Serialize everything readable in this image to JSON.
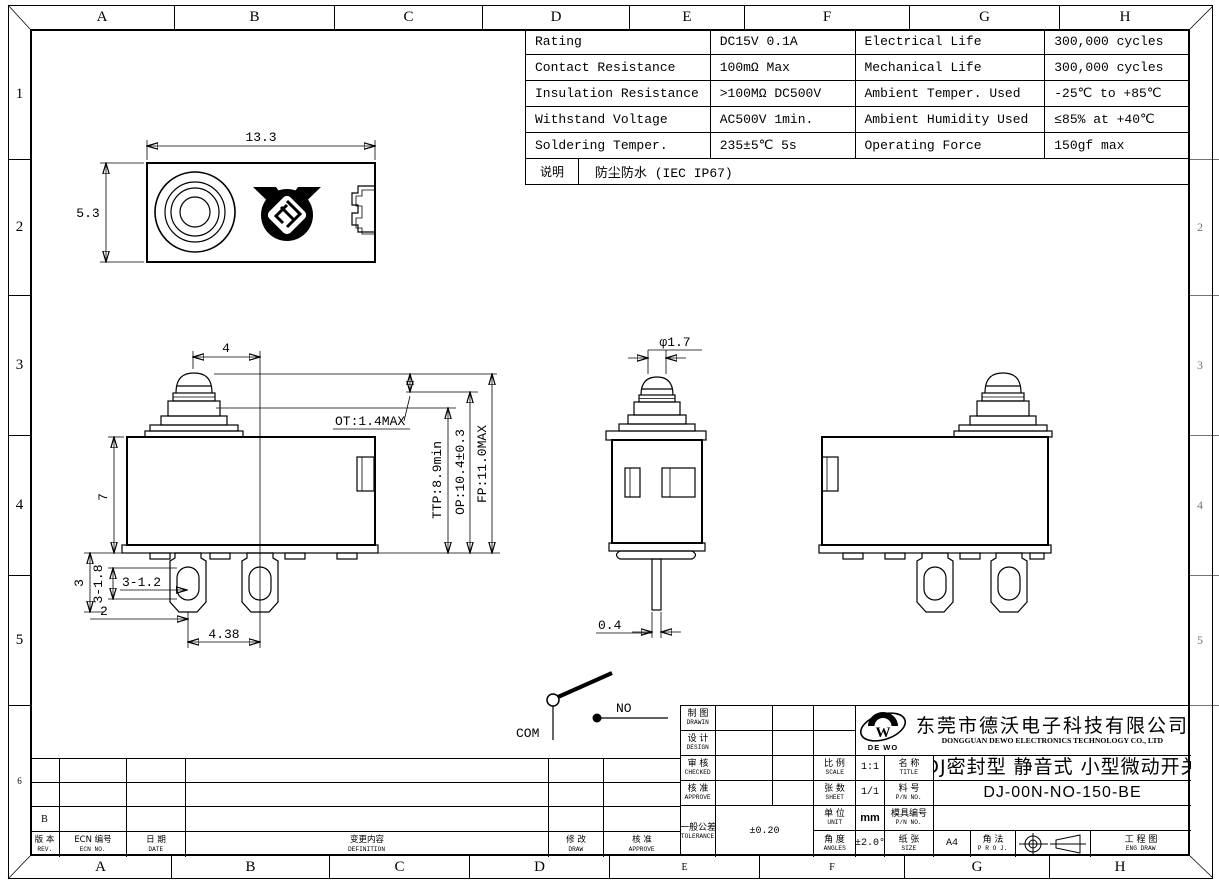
{
  "sheet": {
    "grid_top": [
      "A",
      "B",
      "C",
      "D",
      "E",
      "F",
      "G",
      "H"
    ],
    "grid_bottom": [
      "A",
      "B",
      "C",
      "D",
      "E",
      "F",
      "G",
      "H"
    ],
    "grid_left": [
      "1",
      "2",
      "3",
      "4",
      "5",
      "6"
    ],
    "grid_right": [
      "",
      "2",
      "3",
      "4",
      "5",
      ""
    ]
  },
  "spec_table": {
    "rows": [
      {
        "p1": "Rating",
        "v1": "DC15V 0.1A",
        "p2": "Electrical Life",
        "v2": "300,000 cycles"
      },
      {
        "p1": "Contact Resistance",
        "v1": "100mΩ Max",
        "p2": "Mechanical Life",
        "v2": "300,000 cycles"
      },
      {
        "p1": "Insulation Resistance",
        "v1": ">100MΩ DC500V",
        "p2": "Ambient Temper. Used",
        "v2": "-25℃ to +85℃"
      },
      {
        "p1": "Withstand Voltage",
        "v1": "AC500V 1min.",
        "p2": "Ambient Humidity Used",
        "v2": "≤85% at +40℃"
      },
      {
        "p1": "Soldering Temper.",
        "v1": "235±5℃ 5s",
        "p2": "Operating Force",
        "v2": "150gf max"
      }
    ],
    "note_label": "说明",
    "note_value": "防尘防水 (IEC IP67)"
  },
  "dims": {
    "top_view": {
      "width": "13.3",
      "height": "5.3"
    },
    "front": {
      "plunger": "4",
      "body": "7",
      "ot": "OT:1.4MAX",
      "ttp": "TTP:8.9min",
      "op": "OP:10.4±0.3",
      "fp": "FP:11.0MAX",
      "d3": "3",
      "d3_18": "3-1.8",
      "d3_12": "3-1.2",
      "d2": "2",
      "pitch": "4.38"
    },
    "side": {
      "dia": "φ1.7",
      "pin": "0.4"
    },
    "circuit": {
      "com": "COM",
      "no": "NO"
    }
  },
  "title_block": {
    "drawn_cn": "制 图",
    "drawn_en": "DRAWIN",
    "design_cn": "设 计",
    "design_en": "DESIGN",
    "checked_cn": "审 核",
    "checked_en": "CHECKED",
    "approve_cn": "核 准",
    "approve_en": "APPROVE",
    "tolerance_cn": "一般公差",
    "tolerance_en": "TOLERANCE",
    "tolerance_value": "±0.20",
    "scale_cn": "比 例",
    "scale_en": "SCALE",
    "scale_value": "1:1",
    "sheet_cn": "张 数",
    "sheet_en": "SHEET",
    "sheet_value": "1/1",
    "unit_cn": "单 位",
    "unit_en": "UNIT",
    "unit_value": "mm",
    "angles_cn": "角 度",
    "angles_en": "ANGLES",
    "angles_value": "±2.0°",
    "name_cn": "名 称",
    "name_en": "TITLE",
    "title_value": "DJ密封型 静音式 小型微动开关",
    "pn_cn": "料 号",
    "pn_en": "P/N NO.",
    "pn_value": "DJ-00N-NO-150-BE",
    "mold_cn": "模具编号",
    "mold_en": "P/N NO.",
    "mold_value": "",
    "paper_cn": "纸 张",
    "paper_en": "SIZE",
    "paper_value": "A4",
    "proj_cn": "角 法",
    "proj_en": "P R O J.",
    "eng_cn": "工 程 图",
    "eng_en": "ENG DRAW",
    "company": {
      "logo_letter": "W",
      "logo_sub": "DE WO",
      "name_cn": "东莞市德沃电子科技有限公司",
      "name_en": "DONGGUAN DEWO ELECTRONICS TECHNOLOGY CO., LTD"
    }
  },
  "revision_table": {
    "rev_cn": "版 本",
    "rev_en": "REV.",
    "ecn_cn": "ECN 编号",
    "ecn_en": "ECN NO.",
    "date_cn": "日 期",
    "date_en": "DATE",
    "def_cn": "变更内容",
    "def_en": "DEFINITION",
    "draw_cn": "修 改",
    "draw_en": "DRAW",
    "appr_cn": "核 准",
    "appr_en": "APPROVE",
    "current_rev": "B"
  }
}
